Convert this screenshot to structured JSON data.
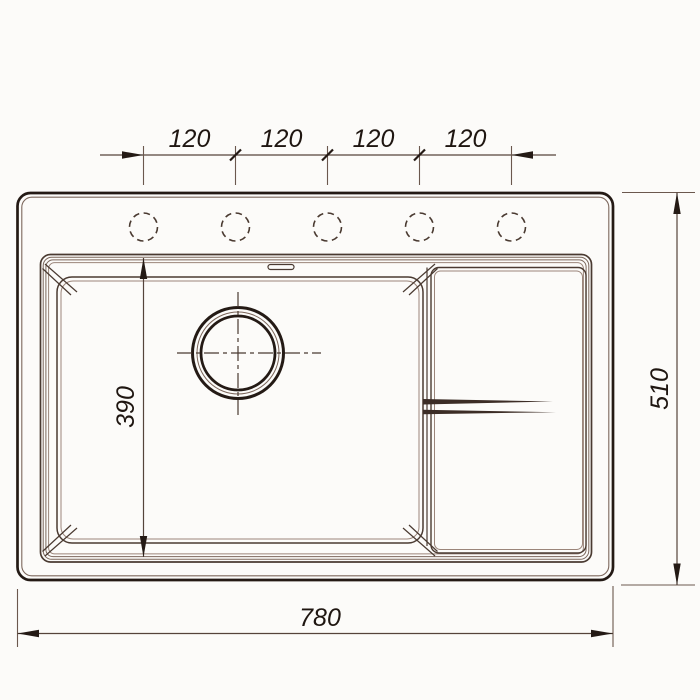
{
  "drawing": {
    "subject": "sink-top-view-technical-drawing",
    "dimensions": {
      "hole_spacing_labels": [
        "120",
        "120",
        "120",
        "120"
      ],
      "bowl_width_label": "390",
      "overall_width_label": "780",
      "overall_depth_label": "510"
    },
    "faucet_hole_count": 5,
    "colors": {
      "outline_dark": "#241a15",
      "line_mid": "#4a3a31",
      "line_thin": "#7c675c",
      "dim_line": "#55443b",
      "text": "#1f1611",
      "background": "#fcfbf9"
    }
  }
}
